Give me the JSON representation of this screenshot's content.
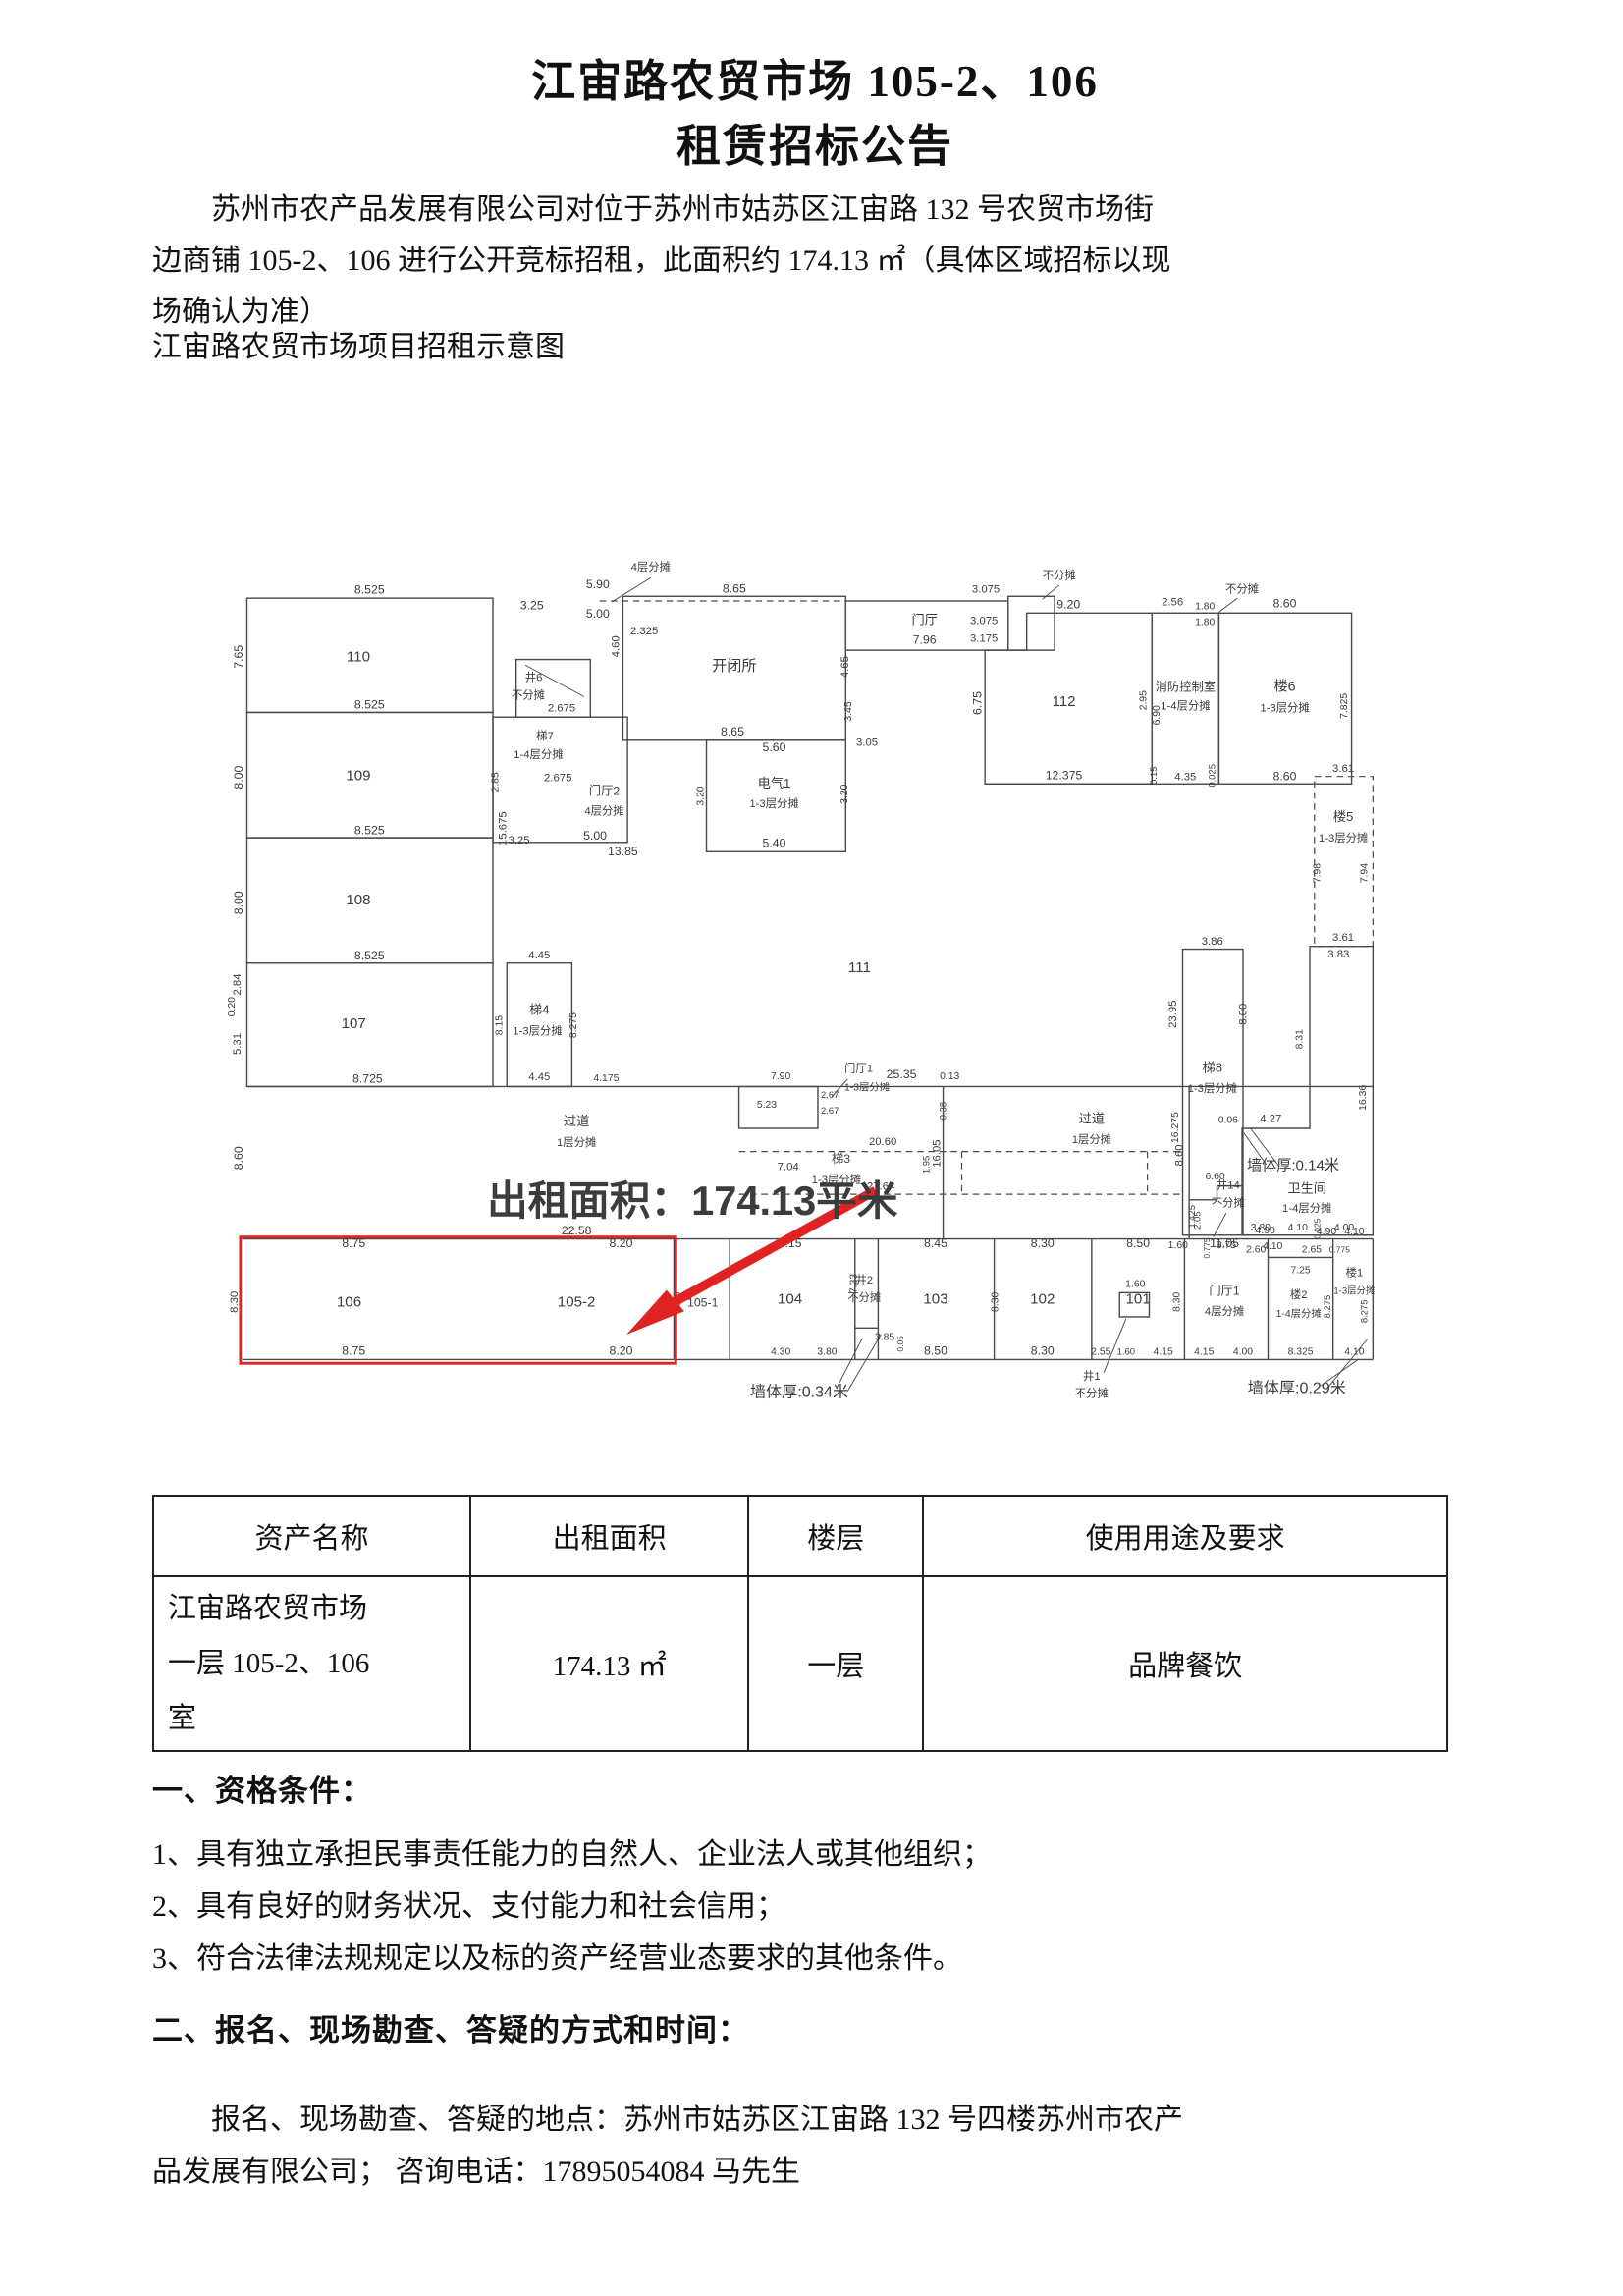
{
  "doc": {
    "title_line1": "江宙路农贸市场 105-2、106",
    "title_line2": "租赁招标公告",
    "intro_lines": [
      "苏州市农产品发展有限公司对位于苏州市姑苏区江宙路 132 号农贸市场街",
      "边商铺 105-2、106 进行公开竞标招租，此面积约 174.13 ㎡（具体区域招标以现",
      "场确认为准）"
    ],
    "diagram_caption": "江宙路农贸市场项目招租示意图",
    "section1": {
      "heading": "一、资格条件：",
      "items": [
        "1、具有独立承担民事责任能力的自然人、企业法人或其他组织；",
        "2、具有良好的财务状况、支付能力和社会信用；",
        "3、符合法律法规规定以及标的资产经营业态要求的其他条件。"
      ]
    },
    "section2": {
      "heading": "二、报名、现场勘查、答疑的方式和时间：",
      "lines": [
        "报名、现场勘查、答疑的地点：苏州市姑苏区江宙路 132 号四楼苏州市农产",
        "品发展有限公司；  咨询电话：17895054084 马先生"
      ]
    }
  },
  "table": {
    "headers": [
      "资产名称",
      "出租面积",
      "楼层",
      "使用用途及要求"
    ],
    "row": [
      "江宙路农贸市场\n一层 105-2、106\n室",
      "174.13 ㎡",
      "一层",
      "品牌餐饮"
    ]
  },
  "plan": {
    "colors": {
      "wall": "#4a4a4a",
      "red": "#e02222"
    },
    "red_overlay": {
      "area_label": "出租面积：174.13平米",
      "label_x": 545,
      "label_y": 716,
      "label_size": 44,
      "rect": [
        58,
        740,
        469,
        136
      ],
      "arrow_line": [
        742,
        690,
        500,
        824
      ],
      "arrow_head": [
        474,
        845,
        517,
        797,
        536,
        820
      ]
    },
    "rects": [
      [
        65,
        52,
        265,
        123
      ],
      [
        65,
        175,
        265,
        135
      ],
      [
        65,
        310,
        265,
        135
      ],
      [
        65,
        445,
        265,
        133
      ],
      [
        355,
        118,
        80,
        62
      ],
      [
        330,
        180,
        145,
        135
      ],
      [
        470,
        50,
        240,
        155
      ],
      [
        560,
        205,
        150,
        120
      ],
      [
        710,
        55,
        175,
        53
      ],
      [
        885,
        50,
        50,
        58
      ],
      [
        1040,
        68,
        72,
        184
      ],
      [
        1112,
        68,
        143,
        184
      ],
      [
        1073,
        430,
        65,
        308
      ],
      [
        345,
        445,
        70,
        133
      ],
      [
        595,
        578,
        85,
        45
      ],
      [
        1005,
        800,
        32,
        26
      ]
    ],
    "polygons": [
      [
        860,
        108,
        905,
        108,
        905,
        68,
        1040,
        68,
        1040,
        252,
        860,
        252
      ],
      [
        1210,
        427,
        1278,
        427,
        1278,
        738,
        1137,
        738,
        1137,
        623,
        1210,
        623
      ]
    ],
    "lines": [
      [
        65,
        578,
        1278,
        578
      ],
      [
        60,
        742,
        1278,
        742
      ],
      [
        60,
        872,
        1278,
        872
      ],
      [
        525,
        742,
        525,
        872
      ],
      [
        585,
        742,
        585,
        872
      ],
      [
        720,
        742,
        720,
        872
      ],
      [
        745,
        742,
        745,
        872
      ],
      [
        870,
        742,
        870,
        872
      ],
      [
        975,
        742,
        975,
        872
      ],
      [
        1075,
        742,
        1075,
        872
      ],
      [
        1165,
        742,
        1165,
        872
      ],
      [
        1235,
        742,
        1235,
        872
      ],
      [
        1278,
        742,
        1278,
        872
      ],
      [
        815,
        578,
        815,
        742
      ],
      [
        1080,
        578,
        1080,
        742
      ],
      [
        1080,
        700,
        1110,
        700
      ],
      [
        1110,
        685,
        1110,
        700
      ],
      [
        1110,
        685,
        1137,
        685
      ],
      [
        1165,
        762,
        1235,
        762
      ],
      [
        720,
        838,
        745,
        838
      ]
    ],
    "leaders": [
      [
        500,
        30,
        458,
        56
      ],
      [
        940,
        38,
        922,
        53
      ],
      [
        1132,
        52,
        1112,
        67
      ],
      [
        365,
        124,
        428,
        158
      ],
      [
        712,
        570,
        695,
        589
      ],
      [
        1120,
        714,
        1106,
        740
      ],
      [
        988,
        886,
        1012,
        828
      ],
      [
        700,
        903,
        728,
        849
      ],
      [
        712,
        906,
        748,
        845
      ],
      [
        1222,
        900,
        1262,
        872
      ],
      [
        1228,
        904,
        1272,
        850
      ],
      [
        1163,
        662,
        1139,
        628
      ],
      [
        1177,
        664,
        1146,
        623
      ]
    ],
    "dashed_lines": [
      [
        445,
        55,
        710,
        55
      ],
      [
        595,
        648,
        1075,
        648
      ],
      [
        595,
        694,
        1075,
        694
      ],
      [
        835,
        648,
        835,
        694
      ],
      [
        1035,
        648,
        1035,
        694
      ]
    ],
    "dashed_rects": [
      [
        1215,
        244,
        63,
        183
      ]
    ],
    "labels": [
      [
        "8.525",
        197,
        47
      ],
      [
        "7.65",
        60,
        115,
        13,
        1
      ],
      [
        "110",
        185,
        120,
        16
      ],
      [
        "8.525",
        197,
        171
      ],
      [
        "8.00",
        60,
        245,
        13,
        1
      ],
      [
        "109",
        185,
        248,
        16
      ],
      [
        "15.675",
        344,
        300,
        12,
        1
      ],
      [
        "8.525",
        197,
        306
      ],
      [
        "8.00",
        60,
        380,
        13,
        1
      ],
      [
        "108",
        185,
        382,
        16
      ],
      [
        "8.525",
        197,
        441
      ],
      [
        "107",
        180,
        515,
        16
      ],
      [
        "2.84",
        58,
        468,
        12,
        1
      ],
      [
        "0.20",
        52,
        492,
        11,
        1
      ],
      [
        "5.31",
        58,
        532,
        12,
        1
      ],
      [
        "8.725",
        195,
        574
      ],
      [
        "3.25",
        372,
        64
      ],
      [
        "5.90",
        443,
        41
      ],
      [
        "4层分摊",
        500,
        22,
        12
      ],
      [
        "5.00",
        443,
        73
      ],
      [
        "2.325",
        493,
        91,
        12
      ],
      [
        "井6",
        374,
        141,
        12
      ],
      [
        "不分摊",
        368,
        160,
        12
      ],
      [
        "2.675",
        404,
        174,
        12
      ],
      [
        "梯7",
        386,
        204,
        12
      ],
      [
        "1-4层分摊",
        379,
        224,
        12
      ],
      [
        "2.675",
        400,
        249,
        12
      ],
      [
        "2.85",
        336,
        250,
        11,
        1
      ],
      [
        "门厅2",
        450,
        264,
        13
      ],
      [
        "4层分摊",
        450,
        285,
        12
      ],
      [
        "5.00",
        440,
        312
      ],
      [
        "3.25",
        358,
        316,
        12
      ],
      [
        "13.85",
        470,
        329
      ],
      [
        "8.65",
        590,
        46
      ],
      [
        "开闭所",
        590,
        130,
        16
      ],
      [
        "8.65",
        588,
        200
      ],
      [
        "4.65",
        713,
        126,
        12,
        1
      ],
      [
        "4.60",
        466,
        104,
        12,
        1
      ],
      [
        "3.45",
        716,
        174,
        11,
        1
      ],
      [
        "3.05",
        733,
        211,
        12
      ],
      [
        "5.60",
        633,
        217
      ],
      [
        "电气1",
        633,
        256,
        14
      ],
      [
        "1-3层分摊",
        633,
        277,
        12
      ],
      [
        "5.40",
        633,
        320
      ],
      [
        "3.20",
        557,
        265,
        11,
        1
      ],
      [
        "3.20",
        712,
        263,
        11,
        1
      ],
      [
        "门厅",
        795,
        80,
        14
      ],
      [
        "7.96",
        795,
        101
      ],
      [
        "3.075",
        861,
        46,
        12
      ],
      [
        "不分摊",
        940,
        31,
        12
      ],
      [
        "3.075",
        859,
        80,
        12
      ],
      [
        "3.175",
        859,
        99,
        12
      ],
      [
        "9.20",
        950,
        63
      ],
      [
        "112",
        945,
        168,
        16
      ],
      [
        "6.75",
        856,
        165,
        13,
        1
      ],
      [
        "12.375",
        945,
        247
      ],
      [
        "2.95",
        1034,
        162,
        11,
        1
      ],
      [
        "2.56",
        1062,
        60,
        12
      ],
      [
        "1.80",
        1097,
        64,
        11
      ],
      [
        "1.80",
        1097,
        81,
        11
      ],
      [
        "不分摊",
        1137,
        46,
        12
      ],
      [
        "消防控制室",
        1076,
        152,
        13
      ],
      [
        "1-4层分摊",
        1076,
        172,
        12
      ],
      [
        "6.90",
        1048,
        178,
        11,
        1
      ],
      [
        "0.15",
        1045,
        243,
        10,
        1
      ],
      [
        "4.35",
        1076,
        248,
        12
      ],
      [
        "0.025",
        1108,
        243,
        10,
        1
      ],
      [
        "8.60",
        1183,
        62
      ],
      [
        "楼6",
        1183,
        152,
        15
      ],
      [
        "1-3层分摊",
        1183,
        174,
        12
      ],
      [
        "7.825",
        1250,
        168,
        11,
        1
      ],
      [
        "8.60",
        1183,
        248
      ],
      [
        "3.61",
        1246,
        239,
        12
      ],
      [
        "楼5",
        1246,
        292,
        14
      ],
      [
        "1-3层分摊",
        1246,
        314,
        12
      ],
      [
        "7.98",
        1221,
        348,
        11,
        1
      ],
      [
        "7.94",
        1272,
        348,
        11,
        1
      ],
      [
        "3.61",
        1246,
        421,
        12
      ],
      [
        "3.83",
        1241,
        439,
        12
      ],
      [
        "3.86",
        1105,
        425,
        12
      ],
      [
        "23.95",
        1066,
        500,
        12,
        1
      ],
      [
        "8.00",
        1142,
        500,
        12,
        1
      ],
      [
        "梯8",
        1105,
        562,
        14
      ],
      [
        "1-3层分摊",
        1105,
        584,
        12
      ],
      [
        "16.275",
        1068,
        622,
        11,
        1
      ],
      [
        "0.06",
        1122,
        617,
        11
      ],
      [
        "8.31",
        1202,
        527,
        11,
        1
      ],
      [
        "16.36",
        1270,
        590,
        11,
        1
      ],
      [
        "4.27",
        1168,
        616,
        12
      ],
      [
        "墙体厚:0.14米",
        1192,
        668,
        16
      ],
      [
        "卫生间",
        1207,
        692,
        14
      ],
      [
        "1-4层分摊",
        1207,
        713,
        12
      ],
      [
        "3.80",
        1157,
        733,
        11
      ],
      [
        "4.10",
        1197,
        733,
        11
      ],
      [
        "0.025",
        1221,
        731,
        9,
        1
      ],
      [
        "4.00",
        1247,
        733,
        11
      ],
      [
        "9.75",
        1120,
        752,
        11
      ],
      [
        "1.60",
        1068,
        752,
        11
      ],
      [
        "1.425",
        1086,
        718,
        10,
        1
      ],
      [
        "6.60",
        1108,
        678,
        11
      ],
      [
        "过道",
        420,
        620,
        14
      ],
      [
        "1层分摊",
        420,
        642,
        12
      ],
      [
        "8.60",
        60,
        655,
        13,
        1
      ],
      [
        "22.58",
        420,
        737
      ],
      [
        "16.05",
        812,
        650,
        12,
        1
      ],
      [
        "0.13",
        822,
        570,
        11
      ],
      [
        "0.38",
        818,
        604,
        10,
        1
      ],
      [
        "过道",
        975,
        617,
        14
      ],
      [
        "1层分摊",
        975,
        639,
        12
      ],
      [
        "8.60",
        1073,
        652,
        12,
        1
      ],
      [
        "25.35",
        770,
        569
      ],
      [
        "20.60",
        750,
        641,
        12
      ],
      [
        "梯3",
        705,
        660,
        13
      ],
      [
        "1-3层分摊",
        700,
        682,
        12
      ],
      [
        "27.64",
        748,
        689,
        12
      ],
      [
        "7.04",
        648,
        668,
        12
      ],
      [
        "1.95",
        800,
        662,
        10,
        1
      ],
      [
        "井14",
        1122,
        688,
        12
      ],
      [
        "不分摊",
        1122,
        707,
        12
      ],
      [
        "4.90",
        1162,
        736,
        11
      ],
      [
        "4.10",
        1170,
        753,
        11
      ],
      [
        "0.775",
        1102,
        752,
        9,
        1
      ],
      [
        "2.05",
        1092,
        722,
        10,
        1
      ],
      [
        "4.45",
        380,
        440,
        12
      ],
      [
        "梯4",
        380,
        500,
        14
      ],
      [
        "1-3层分摊",
        378,
        522,
        12
      ],
      [
        "4.45",
        380,
        571,
        12
      ],
      [
        "8.275",
        420,
        512,
        11,
        1
      ],
      [
        "8.15",
        340,
        512,
        11,
        1
      ],
      [
        "4.175",
        452,
        572,
        11
      ],
      [
        "7.90",
        640,
        570,
        11
      ],
      [
        "5.23",
        625,
        601,
        11
      ],
      [
        "2.67",
        693,
        590,
        10
      ],
      [
        "2.67",
        693,
        607,
        10
      ],
      [
        "门厅1",
        724,
        562,
        12
      ],
      [
        "1-3层分摊",
        733,
        582,
        11
      ],
      [
        "8.75",
        180,
        751
      ],
      [
        "8.20",
        468,
        751
      ],
      [
        "8.15",
        650,
        751
      ],
      [
        "8.45",
        807,
        751
      ],
      [
        "8.30",
        922,
        751
      ],
      [
        "8.50",
        1025,
        751
      ],
      [
        "11.05",
        1118,
        751
      ],
      [
        "4.90",
        1228,
        737,
        11
      ],
      [
        "4.10",
        1258,
        737,
        11
      ],
      [
        "8.30",
        55,
        810,
        12,
        1
      ],
      [
        "106",
        175,
        815,
        16
      ],
      [
        "105-2",
        420,
        815,
        16
      ],
      [
        "105-1",
        556,
        815,
        13
      ],
      [
        "8.30",
        532,
        810,
        11,
        1
      ],
      [
        "104",
        650,
        812,
        16
      ],
      [
        "7.33",
        722,
        790,
        11,
        1
      ],
      [
        "103",
        807,
        812,
        16
      ],
      [
        "8.30",
        874,
        810,
        11,
        1
      ],
      [
        "102",
        922,
        812,
        16
      ],
      [
        "101",
        1025,
        812,
        16
      ],
      [
        "门厅1",
        1118,
        802,
        13
      ],
      [
        "4层分摊",
        1118,
        824,
        12
      ],
      [
        "8.30",
        1070,
        810,
        11,
        1
      ],
      [
        "2.60",
        1152,
        757,
        11
      ],
      [
        "2.65",
        1212,
        757,
        11
      ],
      [
        "7.25",
        1200,
        779,
        11
      ],
      [
        "楼2",
        1198,
        806,
        12
      ],
      [
        "1-4层分摊",
        1198,
        826,
        11
      ],
      [
        "8.275",
        1232,
        815,
        10,
        1
      ],
      [
        "0.775",
        1242,
        757,
        9
      ],
      [
        "楼1",
        1258,
        782,
        12
      ],
      [
        "1-3层分摊",
        1258,
        801,
        10
      ],
      [
        "8.275",
        1272,
        820,
        10,
        1
      ],
      [
        "井2",
        730,
        790,
        12
      ],
      [
        "不分摊",
        730,
        809,
        12
      ],
      [
        "3.85",
        752,
        851,
        11
      ],
      [
        "0.05",
        772,
        855,
        9,
        1
      ],
      [
        "1.60",
        1022,
        794,
        11
      ],
      [
        "井1",
        975,
        894,
        12
      ],
      [
        "不分摊",
        975,
        912,
        12
      ],
      [
        "8.75",
        180,
        867
      ],
      [
        "8.20",
        468,
        867
      ],
      [
        "4.30",
        640,
        867,
        11
      ],
      [
        "3.80",
        690,
        867,
        11
      ],
      [
        "8.50",
        807,
        867
      ],
      [
        "8.30",
        922,
        867
      ],
      [
        "2.55",
        985,
        867,
        11
      ],
      [
        "1.60",
        1012,
        867,
        10
      ],
      [
        "4.15",
        1052,
        867,
        11
      ],
      [
        "4.15",
        1096,
        867,
        11
      ],
      [
        "4.00",
        1138,
        867,
        11
      ],
      [
        "8.325",
        1200,
        867,
        11
      ],
      [
        "4.10",
        1258,
        867,
        11
      ],
      [
        "墙体厚:0.34米",
        660,
        912,
        17
      ],
      [
        "墙体厚:0.29米",
        1196,
        908,
        17
      ],
      [
        "111",
        725,
        455,
        16
      ]
    ]
  }
}
